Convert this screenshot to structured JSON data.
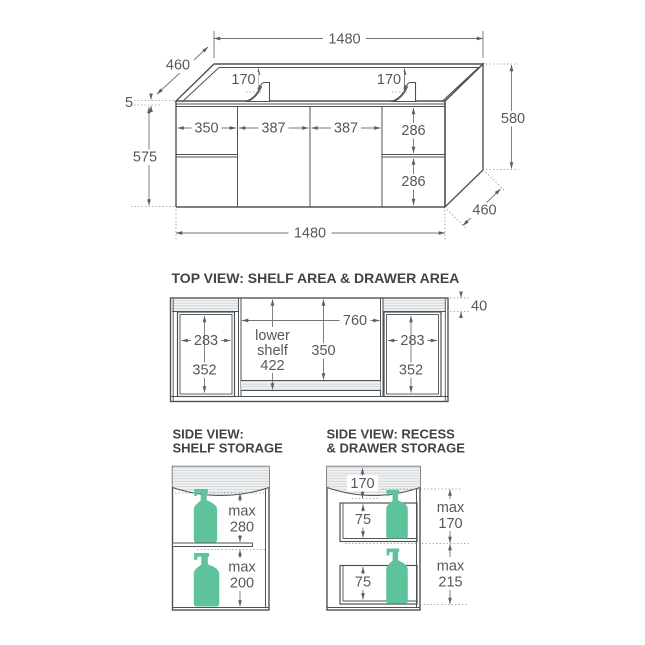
{
  "iso_view": {
    "w_top": "1480",
    "d_top": "460",
    "tap_l": "170",
    "tap_r": "170",
    "bench": "5",
    "h_front": "575",
    "door1": "350",
    "door2": "387",
    "door3": "387",
    "drw_top": "286",
    "drw_bot": "286",
    "h_back": "580",
    "d_bot": "460",
    "w_bot": "1480"
  },
  "top_view": {
    "title": "TOP VIEW: SHELF AREA & DRAWER AREA",
    "rail": "40",
    "cw": "760",
    "shelf_l1": "lower",
    "shelf_l2": "shelf",
    "shelf_d": "422",
    "cd": "350",
    "ldw": "283",
    "ldd": "352",
    "rdw": "283",
    "rdd": "352"
  },
  "side_shelf": {
    "t1": "SIDE VIEW:",
    "t2": "SHELF STORAGE",
    "up1": "max",
    "up2": "280",
    "lo1": "max",
    "lo2": "200"
  },
  "side_drawer": {
    "t1": "SIDE VIEW: RECESS",
    "t2": "& DRAWER STORAGE",
    "recess": "170",
    "d1": "75",
    "d2": "75",
    "up1": "max",
    "up2": "170",
    "lo1": "max",
    "lo2": "215"
  },
  "colors": {
    "accent_green": "#5EC39B",
    "line": "#4E5357",
    "dim_text": "#55595D"
  }
}
